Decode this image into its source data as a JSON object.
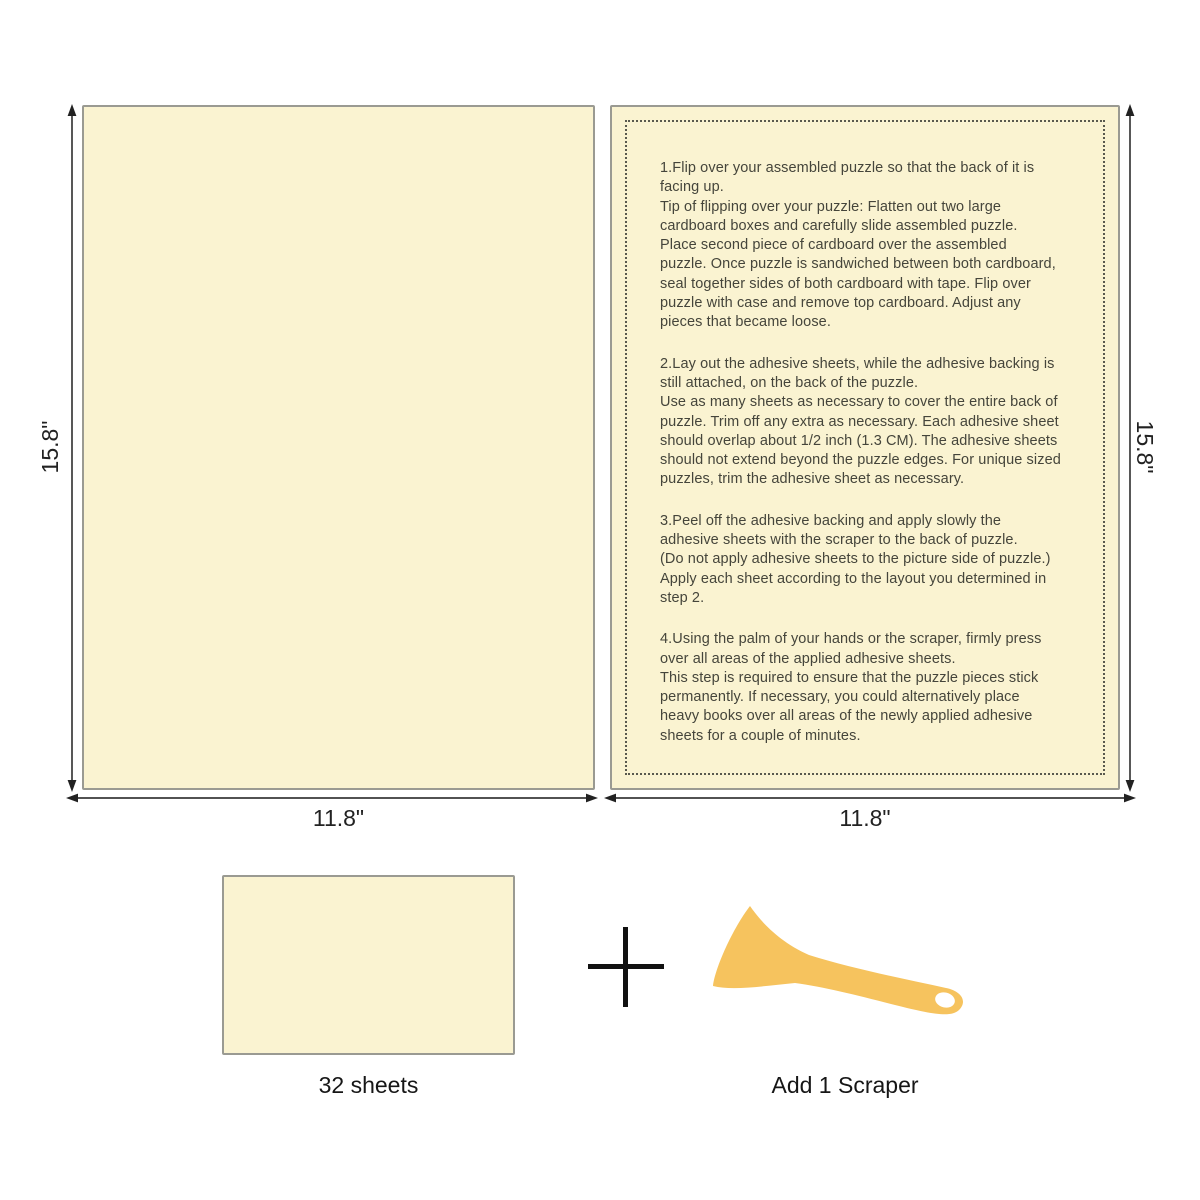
{
  "dimensions": {
    "left_sheet_height": "15.8\"",
    "left_sheet_width": "11.8\"",
    "right_sheet_height": "15.8\"",
    "right_sheet_width": "11.8\""
  },
  "instructions": {
    "step1": "1.Flip over your assembled puzzle so that the back of it is\nfacing up.\nTip of flipping over your puzzle: Flatten out two large\ncardboard boxes and carefully slide assembled puzzle.\nPlace second piece of cardboard over the assembled\npuzzle. Once puzzle is sandwiched between both cardboard,\nseal together sides of both cardboard with tape. Flip over\npuzzle with case and remove top cardboard. Adjust any\npieces that became loose.",
    "step2": "2.Lay out the adhesive sheets, while the adhesive backing is\nstill attached, on the back of the puzzle.\nUse as many sheets as necessary to cover the entire back of\npuzzle. Trim off any extra as necessary. Each adhesive sheet\nshould overlap about 1/2 inch (1.3 CM). The adhesive sheets\nshould not extend beyond the puzzle edges. For unique sized\npuzzles, trim the adhesive sheet as necessary.",
    "step3": "3.Peel off the adhesive backing and apply slowly the\nadhesive sheets with the scraper to the back of puzzle.\n(Do not apply adhesive sheets to the picture side of puzzle.)\nApply each sheet according to the layout you determined in\nstep 2.",
    "step4": "4.Using the palm of your hands or the scraper, firmly press\nover all areas of the applied adhesive sheets.\nThis step is required to ensure that the puzzle pieces stick\npermanently. If necessary, you could alternatively place\nheavy books over all areas of the newly applied adhesive\nsheets for a couple of minutes."
  },
  "bottom": {
    "sheet_count_label": "32 sheets",
    "plus_sign": "+",
    "scraper_label": "Add 1 Scraper"
  },
  "colors": {
    "sheet_fill": "#faf3d1",
    "sheet_border": "#9a9a92",
    "dotted_border": "#59594e",
    "instruction_text": "#45453b",
    "arrow": "#3a3a3a",
    "label_text": "#161616",
    "scraper_fill": "#f6c35e"
  }
}
